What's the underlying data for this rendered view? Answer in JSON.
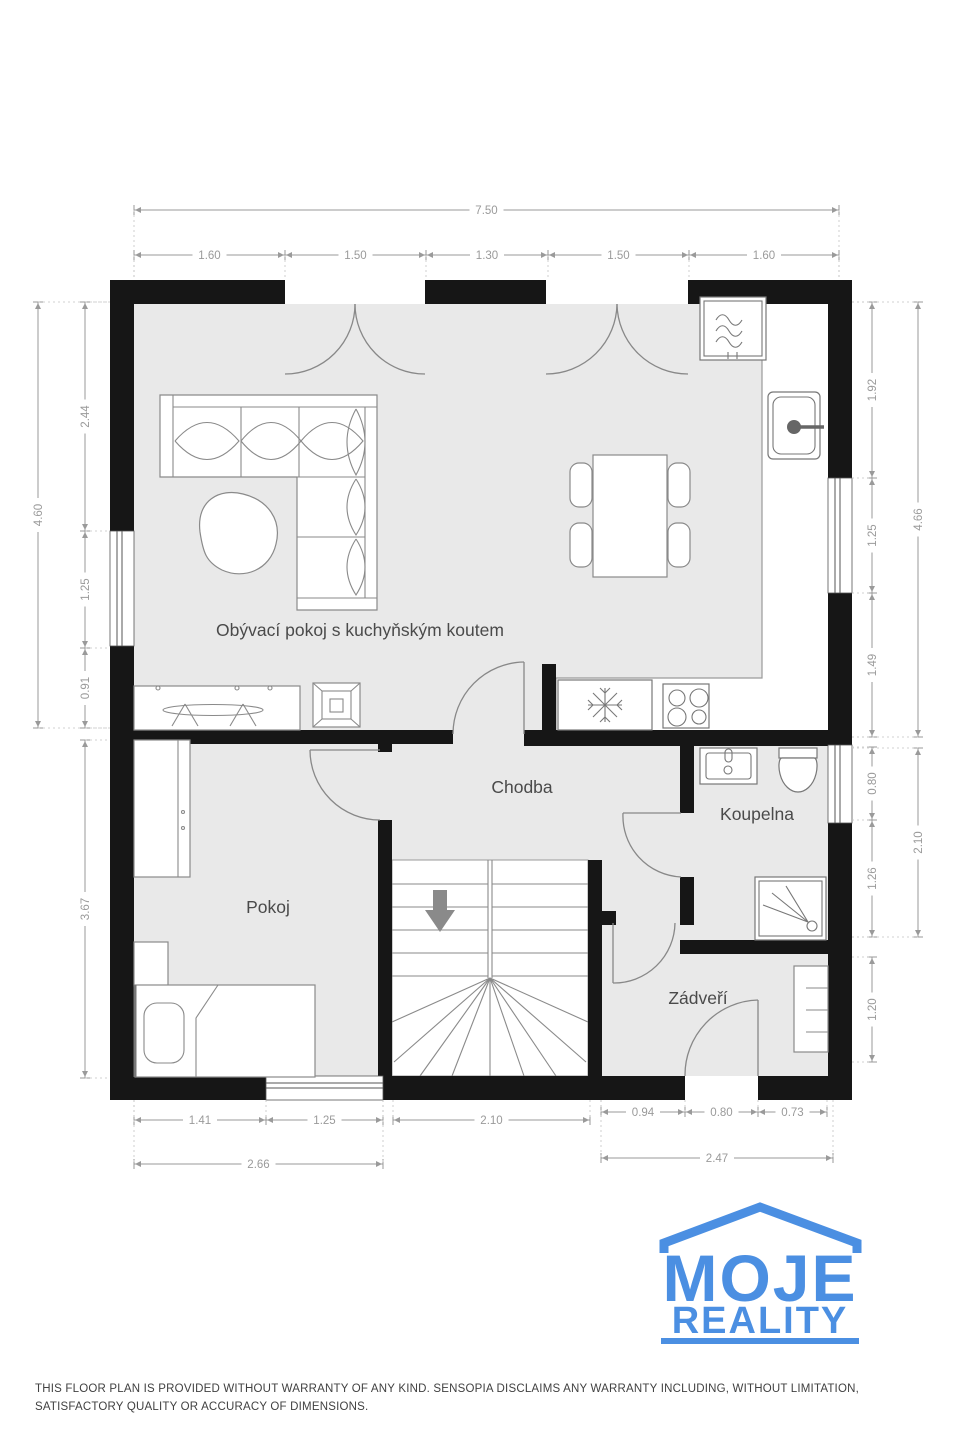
{
  "floorplan": {
    "labels": {
      "living": "Obývací pokoj s kuchyňským koutem",
      "hallway": "Chodba",
      "bathroom": "Koupelna",
      "room": "Pokoj",
      "entry": "Zádveří"
    },
    "dimensions": {
      "top_total": "7.50",
      "top_segments": [
        "1.60",
        "1.50",
        "1.30",
        "1.50",
        "1.60"
      ],
      "left_upper_total": "4.60",
      "left_upper_segments": [
        "2.44",
        "1.25",
        "0.91"
      ],
      "left_lower": "3.67",
      "right_upper_total": "4.66",
      "right_upper_segments": [
        "1.92",
        "1.25",
        "1.49"
      ],
      "right_mid_total": "2.10",
      "right_mid_segments": [
        "0.80",
        "1.26"
      ],
      "right_lower": "1.20",
      "bottom_left_segments": [
        "1.41",
        "1.25"
      ],
      "bottom_left_total": "2.66",
      "bottom_stairs": "2.10",
      "bottom_right_segments": [
        "0.94",
        "0.80",
        "0.73"
      ],
      "bottom_right_total": "2.47"
    },
    "colors": {
      "wall": "#161616",
      "floor": "#e9e9e9",
      "dimension": "#9a9a9a"
    }
  },
  "logo": {
    "title": "MOJE",
    "subtitle": "REALITY",
    "color": "#4b8fe2"
  },
  "disclaimer": "THIS FLOOR PLAN IS PROVIDED WITHOUT WARRANTY OF ANY KIND. SENSOPIA DISCLAIMS ANY WARRANTY INCLUDING, WITHOUT LIMITATION, SATISFACTORY QUALITY OR ACCURACY OF DIMENSIONS."
}
